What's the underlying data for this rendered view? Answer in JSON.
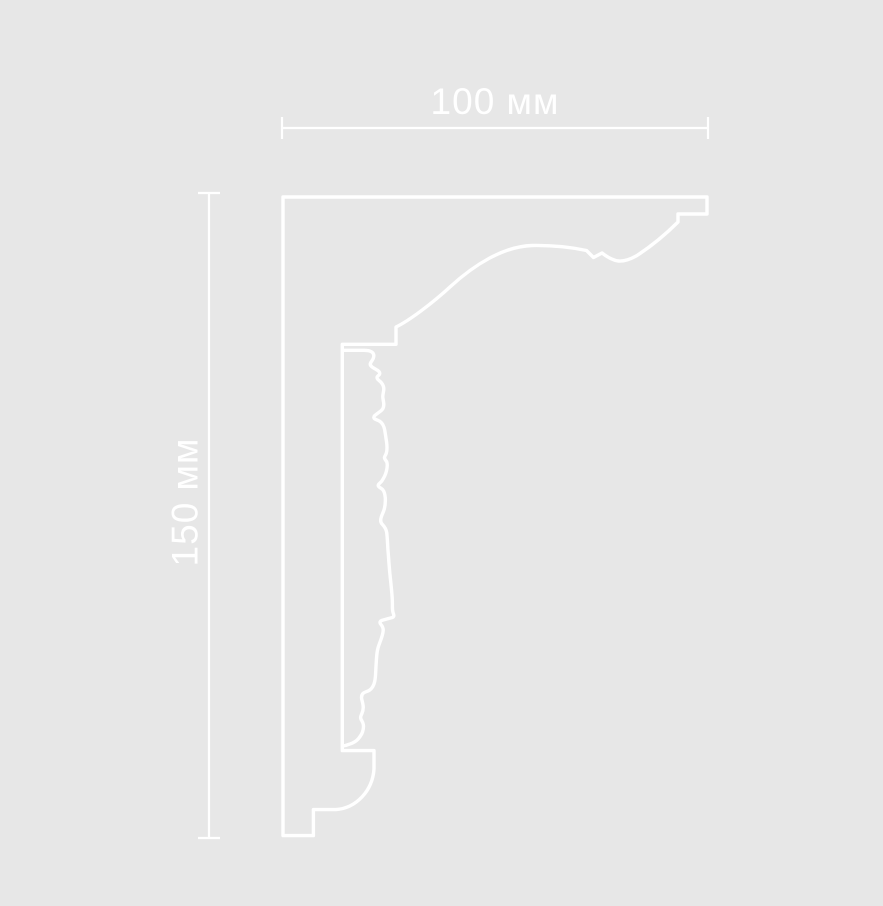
{
  "figure": {
    "colors": {
      "background": "#e7e7e7",
      "line": "#ffffff",
      "text": "#ffffff"
    },
    "dimensions": {
      "width_label": "100 мм",
      "height_label": "150 мм",
      "width_value": 100,
      "height_value": 150,
      "unit": "мм"
    }
  }
}
